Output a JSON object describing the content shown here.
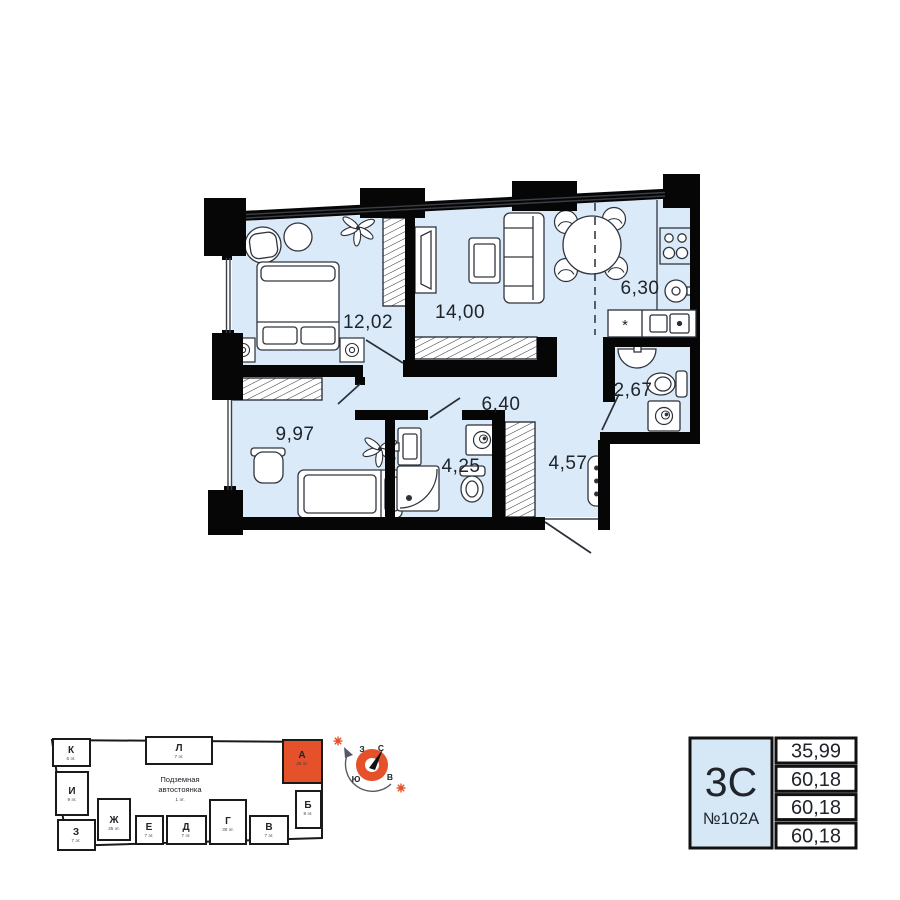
{
  "plan": {
    "rooms": [
      {
        "name": "bedroom",
        "area": "12,02"
      },
      {
        "name": "living-room",
        "area": "14,00"
      },
      {
        "name": "kitchen-dining",
        "area": "6,30"
      },
      {
        "name": "bathroom-small",
        "area": "2,67"
      },
      {
        "name": "hallway",
        "area": "6,40"
      },
      {
        "name": "children-room",
        "area": "9,97"
      },
      {
        "name": "bathroom",
        "area": "4,25"
      },
      {
        "name": "entry-hall",
        "area": "4,57"
      }
    ],
    "star_symbol": "*"
  },
  "building": {
    "parking_line1": "Подземная",
    "parking_line2": "автостоянка",
    "parking_floor": "1 эт.",
    "sections": [
      {
        "letter": "К",
        "floors": "6 эт."
      },
      {
        "letter": "И",
        "floors": "9 эт."
      },
      {
        "letter": "З",
        "floors": "7 эт."
      },
      {
        "letter": "Ж",
        "floors": "25 эт."
      },
      {
        "letter": "Е",
        "floors": "7 эт."
      },
      {
        "letter": "Д",
        "floors": "7 эт."
      },
      {
        "letter": "Г",
        "floors": "30 эт."
      },
      {
        "letter": "В",
        "floors": "7 эт."
      },
      {
        "letter": "Б",
        "floors": "8 эт."
      },
      {
        "letter": "Л",
        "floors": "7 эт."
      },
      {
        "letter": "А",
        "floors": "25 эт.",
        "highlighted": true
      }
    ]
  },
  "compass": {
    "north": "С",
    "east": "В",
    "south": "Ю",
    "west": "З"
  },
  "info_card": {
    "layout_type": "3С",
    "apartment_number": "№102А",
    "areas": [
      "35,99",
      "60,18",
      "60,18",
      "60,18"
    ]
  },
  "colors": {
    "accent_orange": "#e5512b",
    "room_fill": "#daeaf8",
    "wall": "#060606",
    "card_fill": "#d6e8f6"
  }
}
